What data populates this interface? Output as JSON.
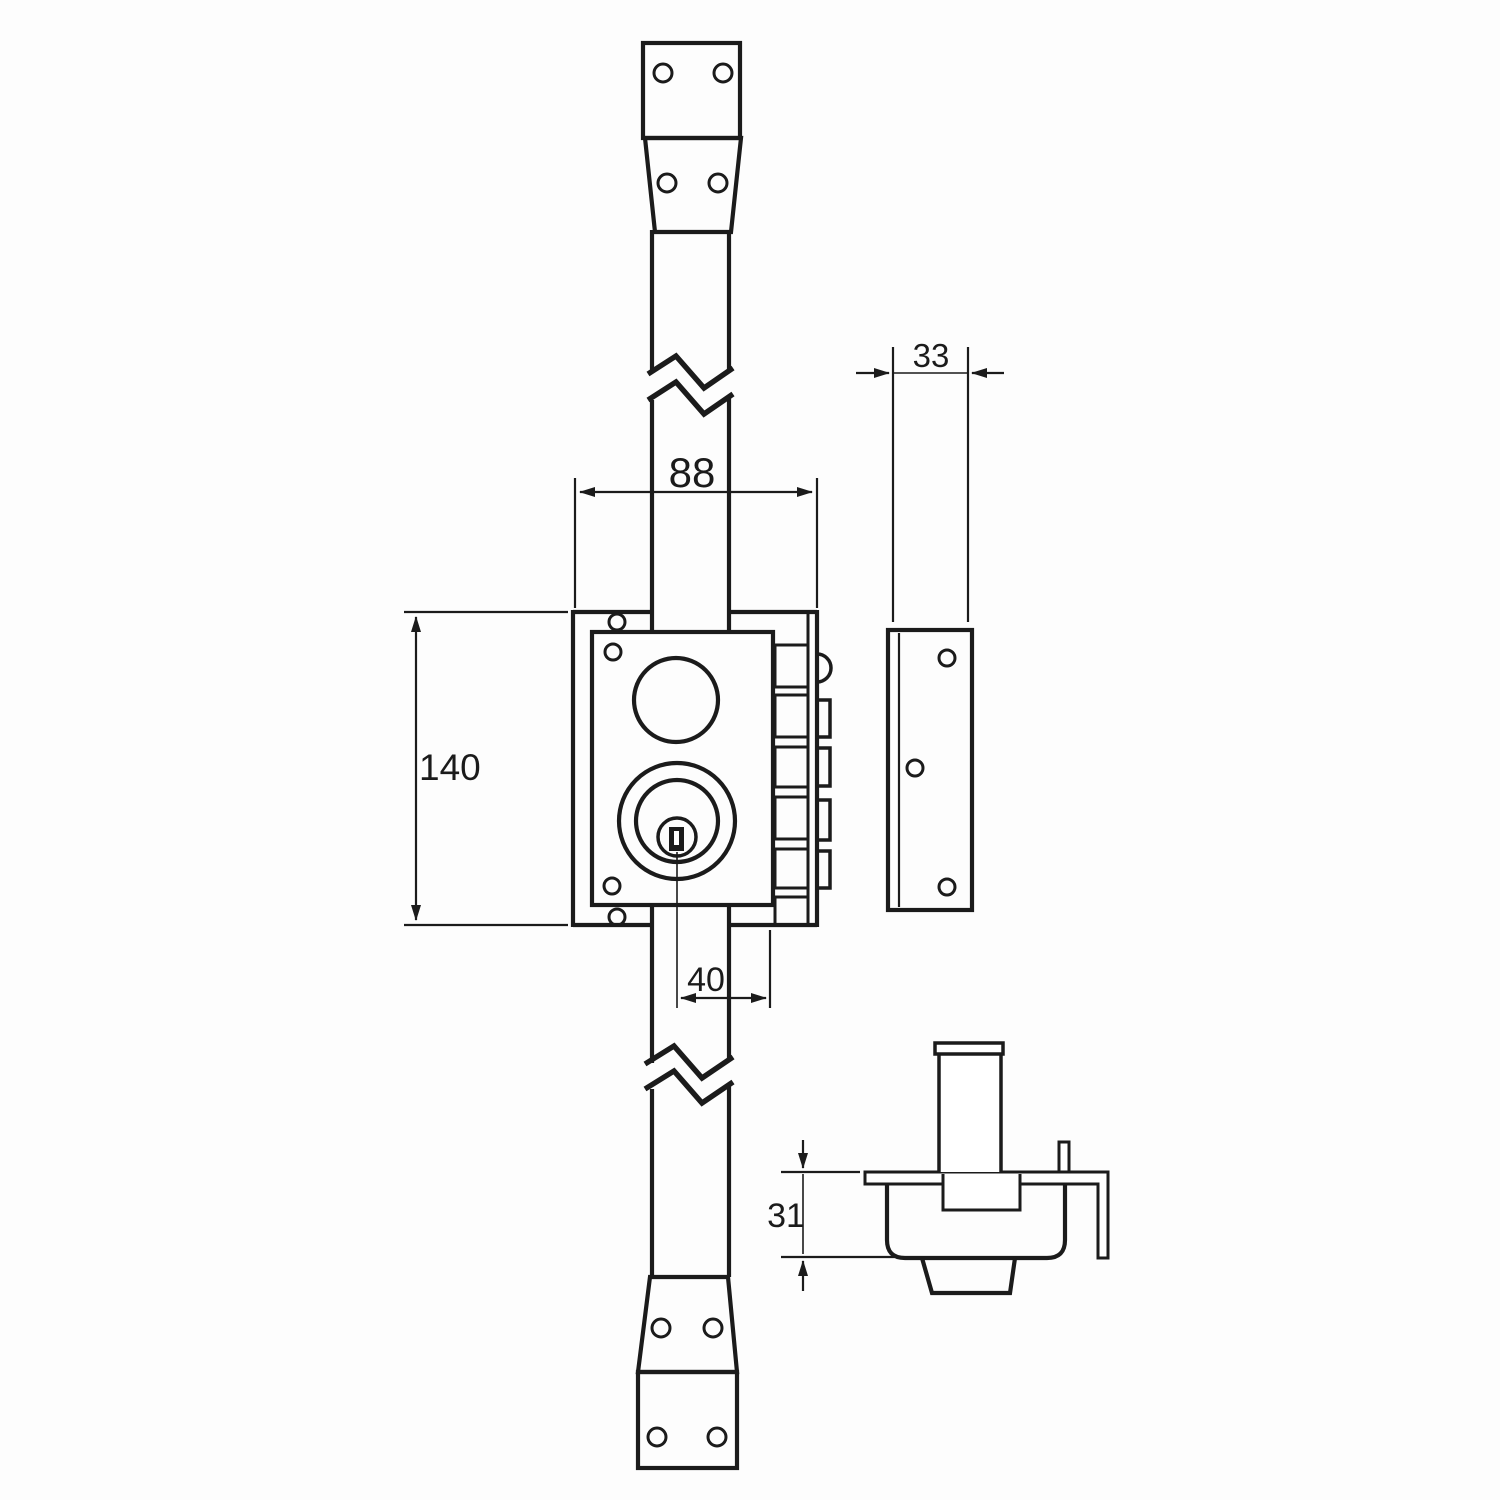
{
  "colors": {
    "line": "#1b1b1b",
    "background": "#fdfdfd"
  },
  "dimensions": {
    "lock_width": {
      "label": "88"
    },
    "lock_height": {
      "label": "140"
    },
    "cylinder_offset": {
      "label": "40"
    },
    "strike_width": {
      "label": "33"
    },
    "cylinder_height": {
      "label": "31"
    }
  },
  "parts": [
    "rod-top-mounting-strap",
    "vertical-rod",
    "rod-break-symbols",
    "lock-back-plate",
    "lock-front-plate",
    "follower-hole",
    "key-cylinder-rosette",
    "keyway",
    "latch-and-deadbolts",
    "strike-plate",
    "rod-bottom-mounting-strap",
    "cylinder-cross-section"
  ]
}
